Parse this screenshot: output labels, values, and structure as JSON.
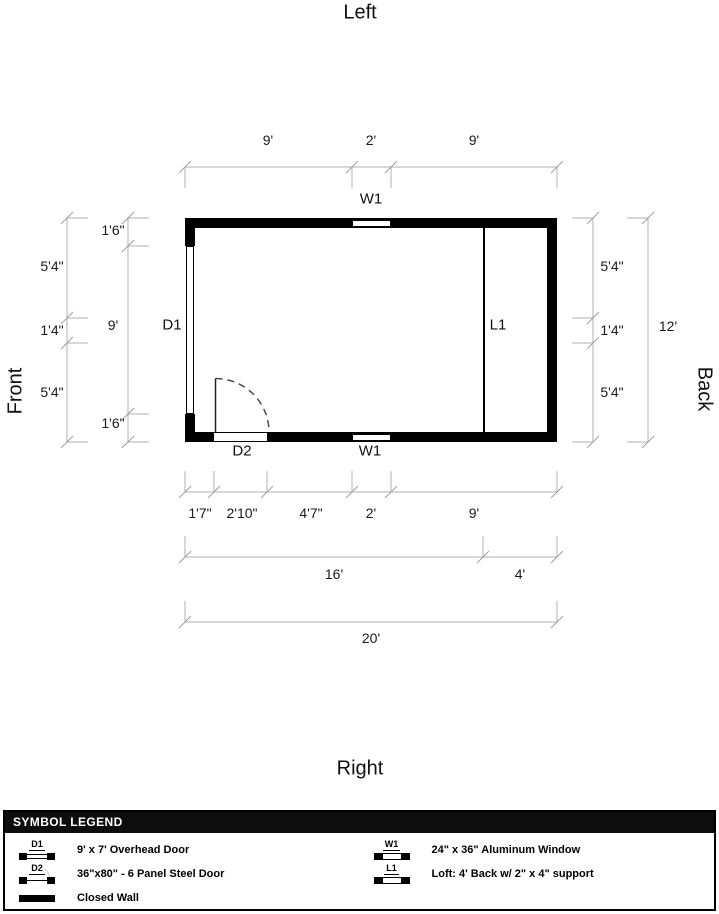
{
  "orientation": {
    "top": "Left",
    "bottom": "Right",
    "front": "Front",
    "back": "Back"
  },
  "plan": {
    "openings": {
      "d1": "D1",
      "d2": "D2",
      "w1_top": "W1",
      "w1_bottom": "W1",
      "l1": "L1"
    }
  },
  "dimensions": {
    "top": [
      "9'",
      "2'",
      "9'"
    ],
    "left_outer": [
      "5'4\"",
      "1'4\"",
      "5'4\""
    ],
    "left_inner": [
      "1'6\"",
      "9'",
      "1'6\""
    ],
    "right_inner": [
      "5'4\"",
      "1'4\"",
      "5'4\""
    ],
    "right_outer": "12'",
    "bottom_widths": [
      "1'7\"",
      "2'10\"",
      "4'7\"",
      "2'",
      "9'"
    ],
    "bottom_sections": [
      "16'",
      "4'"
    ],
    "bottom_total": "20'"
  },
  "legend": {
    "title": "SYMBOL LEGEND",
    "columns": [
      {
        "items": [
          {
            "code": "D1",
            "type": "overhead-door",
            "description": "9' x 7' Overhead Door"
          },
          {
            "code": "D2",
            "type": "steel-door",
            "description": "36\"x80\" - 6 Panel Steel Door"
          },
          {
            "code": "",
            "type": "closed-wall",
            "description": "Closed Wall"
          }
        ]
      },
      {
        "items": [
          {
            "code": "W1",
            "type": "window",
            "description": "24\" x 36\" Aluminum Window"
          },
          {
            "code": "L1",
            "type": "loft",
            "description": "Loft: 4' Back w/ 2\" x 4\" support"
          }
        ]
      }
    ]
  },
  "colors": {
    "wall": "#000000",
    "dimension_line": "#b0b0b0",
    "legend_header_bg": "#0d0d0d"
  }
}
